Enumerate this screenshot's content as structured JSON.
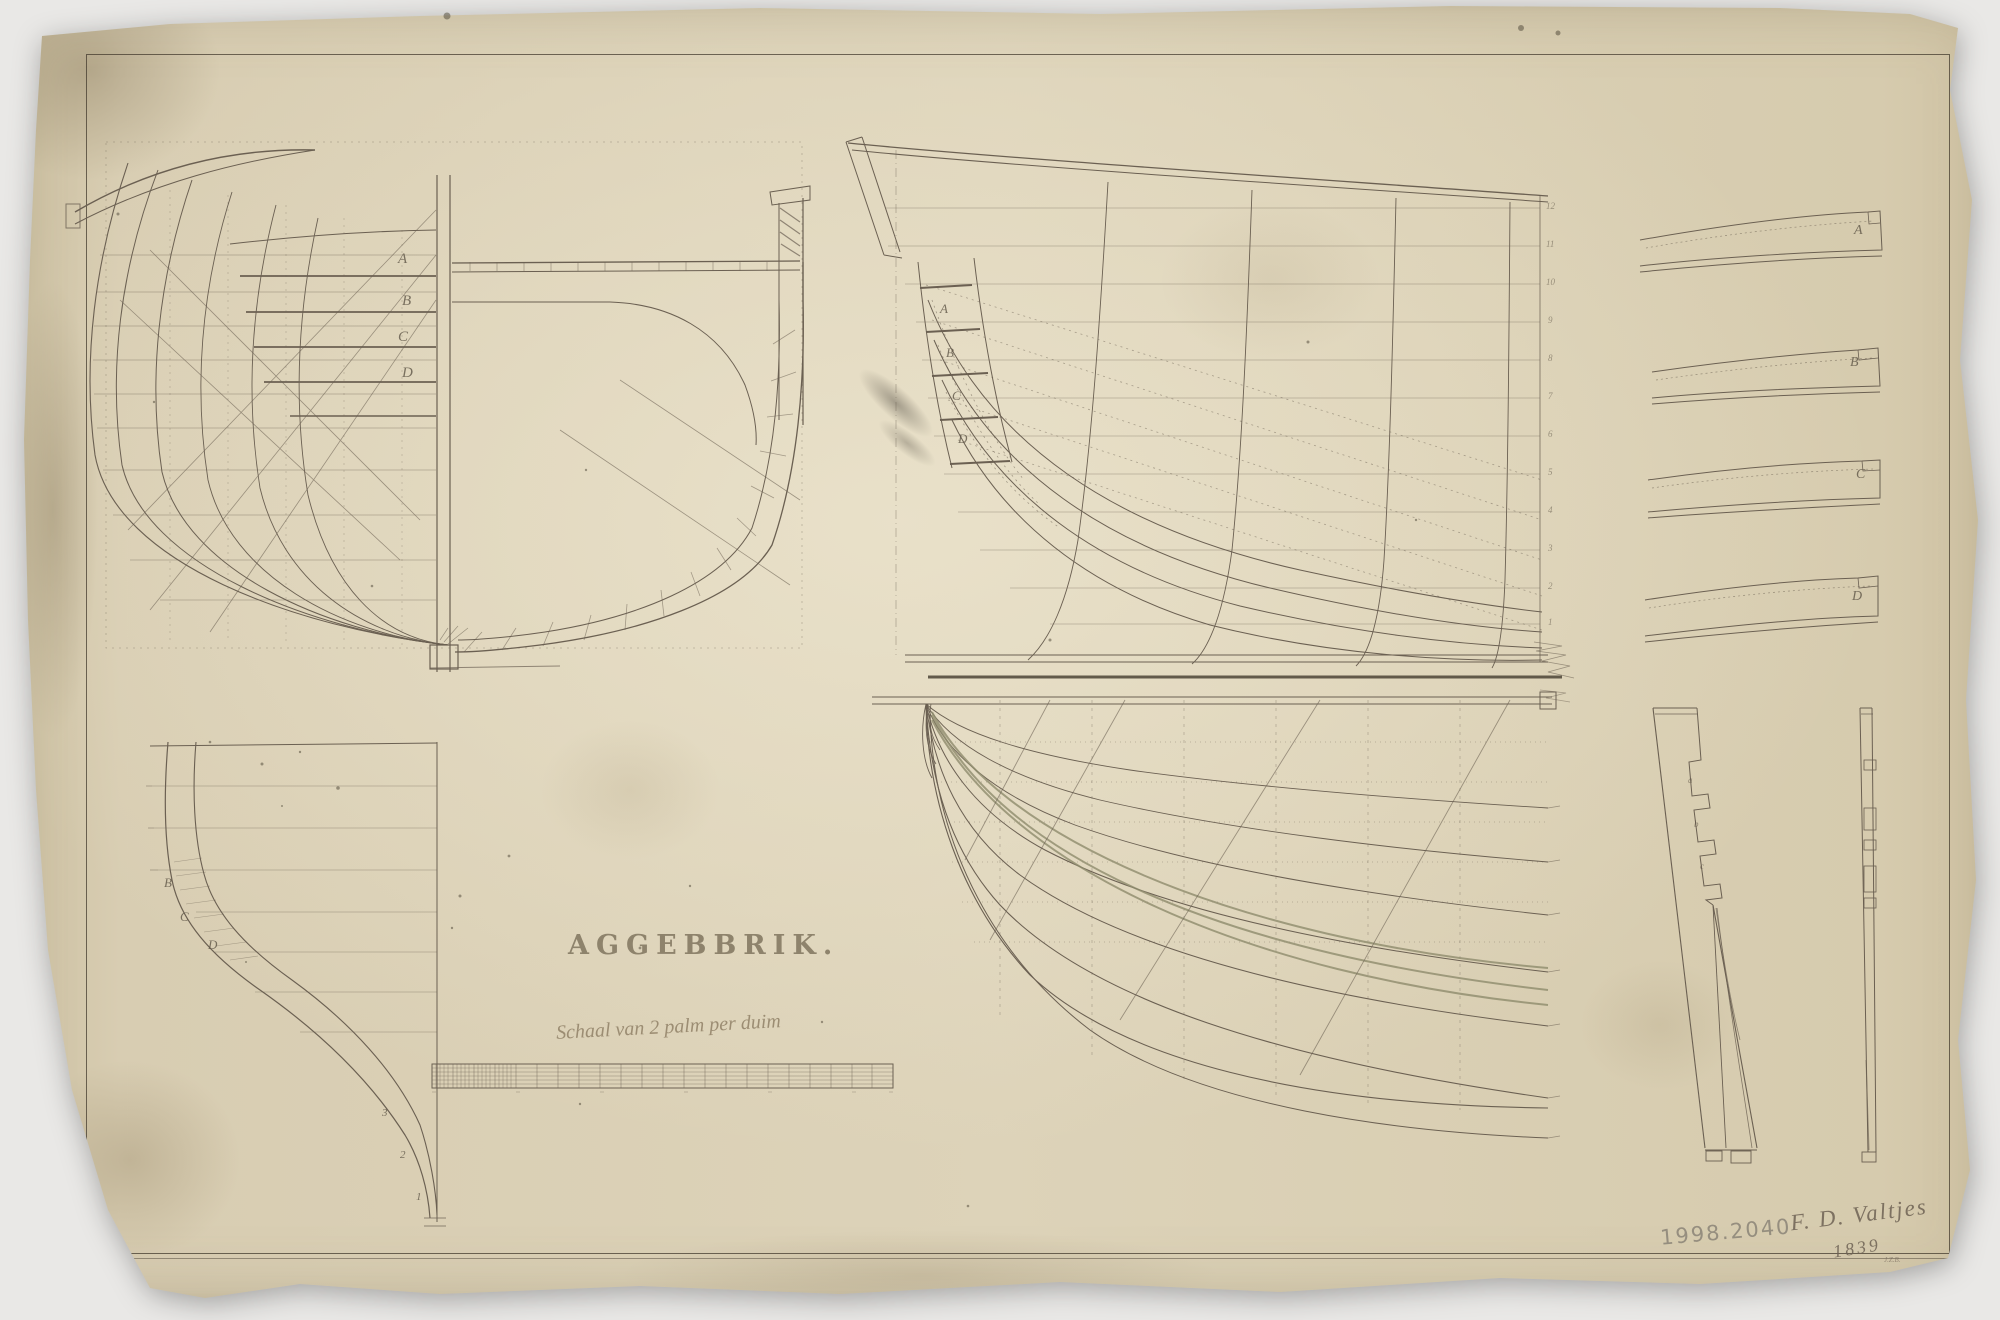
{
  "document": {
    "title": "AGGEBBRIK.",
    "scale_caption": "Schaal van 2 palm per duim",
    "signature_name": "F. D. Valtjes",
    "signature_year": "1839",
    "corner_mark": "J.Z.B.",
    "pencil_inventory_number": "1998.2040"
  },
  "body_plan": {
    "station_labels": [
      "A",
      "B",
      "C",
      "D"
    ]
  },
  "sheer_plan": {
    "station_labels": [
      "A",
      "B",
      "C",
      "D"
    ],
    "waterline_ticks": [
      "12",
      "11",
      "10",
      "9",
      "8",
      "7",
      "6",
      "5",
      "4",
      "3",
      "2",
      "1"
    ]
  },
  "stem_profile": {
    "station_labels": [
      "B",
      "C",
      "D"
    ],
    "number_labels": [
      "3",
      "2",
      "1"
    ]
  },
  "plank_details": {
    "labels": [
      "A",
      "B",
      "C",
      "D"
    ]
  },
  "sternpost": {
    "labels": [
      "a",
      "b",
      "c"
    ]
  },
  "colors": {
    "paper": "#d8cdb2",
    "ink": "#6b6052",
    "dark_ink": "#4b4335",
    "faded_ink": "#95866c",
    "pencil": "#8f887a",
    "green_tint": "#8f8c6d",
    "background": "#e9e8e6"
  }
}
